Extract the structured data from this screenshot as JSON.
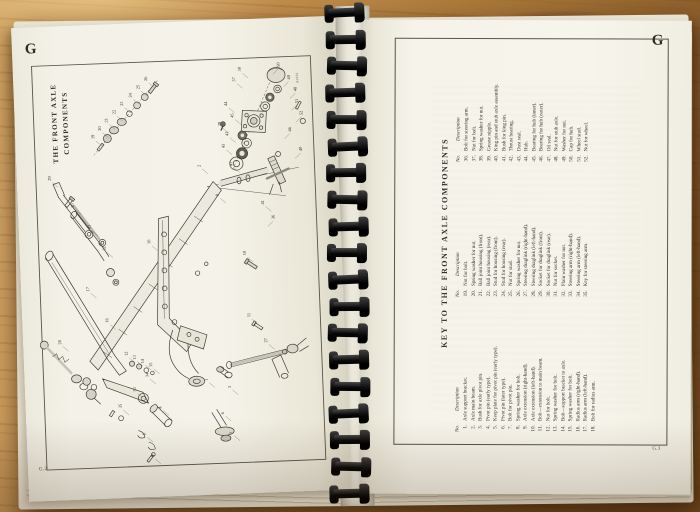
{
  "colors": {
    "binding": "#141414",
    "ink": "#33312c",
    "paper": "#f4f2e8",
    "desk_wood": "#b5813f"
  },
  "book": {
    "left_page": {
      "section_letter": "G",
      "page_number": "G.2",
      "title_lines": [
        "THE FRONT AXLE",
        "COMPONENTS"
      ],
      "figure_code": "A3051",
      "diagram_labels": [
        [
          1,
          183,
          360
        ],
        [
          2,
          184,
          146
        ],
        [
          3,
          206,
          368
        ],
        [
          4,
          136,
          386
        ],
        [
          5,
          119,
          412
        ],
        [
          6,
          198,
          394
        ],
        [
          7,
          206,
          414
        ],
        [
          8,
          126,
          434
        ],
        [
          9,
          201,
          176
        ],
        [
          10,
          131,
          221
        ],
        [
          11,
          228,
          298
        ],
        [
          12,
          104,
          332
        ],
        [
          13,
          112,
          336
        ],
        [
          14,
          120,
          340
        ],
        [
          15,
          128,
          344
        ],
        [
          16,
          86,
          298
        ],
        [
          17,
          68,
          266
        ],
        [
          18,
          226,
          236
        ],
        [
          19,
          79,
          114
        ],
        [
          20,
          86,
          106
        ],
        [
          21,
          93,
          98
        ],
        [
          22,
          101,
          90
        ],
        [
          23,
          109,
          82
        ],
        [
          24,
          118,
          74
        ],
        [
          25,
          126,
          66
        ],
        [
          26,
          134,
          58
        ],
        [
          27,
          244,
          324
        ],
        [
          28,
          38,
          318
        ],
        [
          29,
          34,
          154
        ],
        [
          30,
          56,
          182
        ],
        [
          31,
          72,
          204
        ],
        [
          32,
          86,
          226
        ],
        [
          33,
          111,
          368
        ],
        [
          34,
          124,
          354
        ],
        [
          35,
          96,
          384
        ],
        [
          36,
          256,
          201
        ],
        [
          37,
          222,
          62
        ],
        [
          38,
          228,
          52
        ],
        [
          39,
          206,
          106
        ],
        [
          40,
          286,
          134
        ],
        [
          41,
          246,
          186
        ],
        [
          42,
          213,
          116
        ],
        [
          43,
          209,
          128
        ],
        [
          44,
          213,
          86
        ],
        [
          45,
          219,
          98
        ],
        [
          46,
          276,
          114
        ],
        [
          47,
          216,
          146
        ],
        [
          48,
          283,
          74
        ],
        [
          49,
          277,
          62
        ],
        [
          50,
          267,
          49
        ],
        [
          51,
          284,
          86
        ],
        [
          52,
          288,
          98
        ]
      ]
    },
    "right_page": {
      "section_letter": "G",
      "page_number": "G.3",
      "key_title": "KEY TO THE FRONT AXLE COMPONENTS",
      "col_headers": {
        "no": "No.",
        "desc": "Description"
      },
      "columns": [
        [
          [
            "1.",
            "Axle support bracket."
          ],
          [
            "2.",
            "Axle main beam."
          ],
          [
            "3.",
            "Bush for axle pivot pin."
          ],
          [
            "4.",
            "Pivot pin (early type)."
          ],
          [
            "5.",
            "Keep plate for pivot pin (early type)."
          ],
          [
            "6.",
            "Pivot pin (later type)."
          ],
          [
            "7.",
            "Bolt for pivot pin."
          ],
          [
            "8.",
            "Spring washer for bolt."
          ],
          [
            "9.",
            "Axle extension (right-hand)."
          ],
          [
            "10.",
            "Axle extension (left-hand)."
          ],
          [
            "11.",
            "Bolt—extension to main beam."
          ],
          [
            "12.",
            "Nut for bolt."
          ],
          [
            "13.",
            "Spring washer for bolt."
          ],
          [
            "14.",
            "Bolt—support bracket to axle."
          ],
          [
            "15.",
            "Spring washer for bolt."
          ],
          [
            "16.",
            "Radius arm (right-hand)."
          ],
          [
            "17.",
            "Radius arm (left-hand)."
          ],
          [
            "18.",
            "Bolt for radius arm."
          ]
        ],
        [
          [
            "19.",
            "Nut for bolt."
          ],
          [
            "20.",
            "Spring washer for nut."
          ],
          [
            "21.",
            "Ball joint housing (front)."
          ],
          [
            "22.",
            "Ball joint housing (rear)."
          ],
          [
            "23.",
            "Stud for housing (front)."
          ],
          [
            "24.",
            "Stud for housing (rear)."
          ],
          [
            "25.",
            "Nut for stud."
          ],
          [
            "26.",
            "Spring washer for nut."
          ],
          [
            "27.",
            "Steering draglink (right-hand)."
          ],
          [
            "28.",
            "Steering draglink (left-hand)."
          ],
          [
            "29.",
            "Socket for draglink (front)."
          ],
          [
            "30.",
            "Socket for draglink (rear)."
          ],
          [
            "31.",
            "Nut for socket."
          ],
          [
            "32.",
            "Plain washer for nut."
          ],
          [
            "33.",
            "Steering arm (right-hand)."
          ],
          [
            "34.",
            "Steering arm (left-hand)."
          ],
          [
            "35.",
            "Key for steering arm."
          ]
        ],
        [
          [
            "36.",
            "Bolt for steering arm."
          ],
          [
            "37.",
            "Nut for bolt."
          ],
          [
            "38.",
            "Spring washer for nut."
          ],
          [
            "39.",
            "Grease nipple."
          ],
          [
            "40.",
            "King pin and stub axle assembly."
          ],
          [
            "41.",
            "Bush for king pin."
          ],
          [
            "42.",
            "Thrust bearing."
          ],
          [
            "43.",
            "Dust seal."
          ],
          [
            "44.",
            "Hub."
          ],
          [
            "45.",
            "Bearing for hub (inner)."
          ],
          [
            "46.",
            "Bearing for hub (outer)."
          ],
          [
            "47.",
            "Oil seal."
          ],
          [
            "48.",
            "Nut for stub axle."
          ],
          [
            "49.",
            "Washer for nut."
          ],
          [
            "50.",
            "Cap for hub."
          ],
          [
            "51.",
            "Wheel stud."
          ],
          [
            "52.",
            "Nut for wheel."
          ]
        ]
      ]
    }
  }
}
